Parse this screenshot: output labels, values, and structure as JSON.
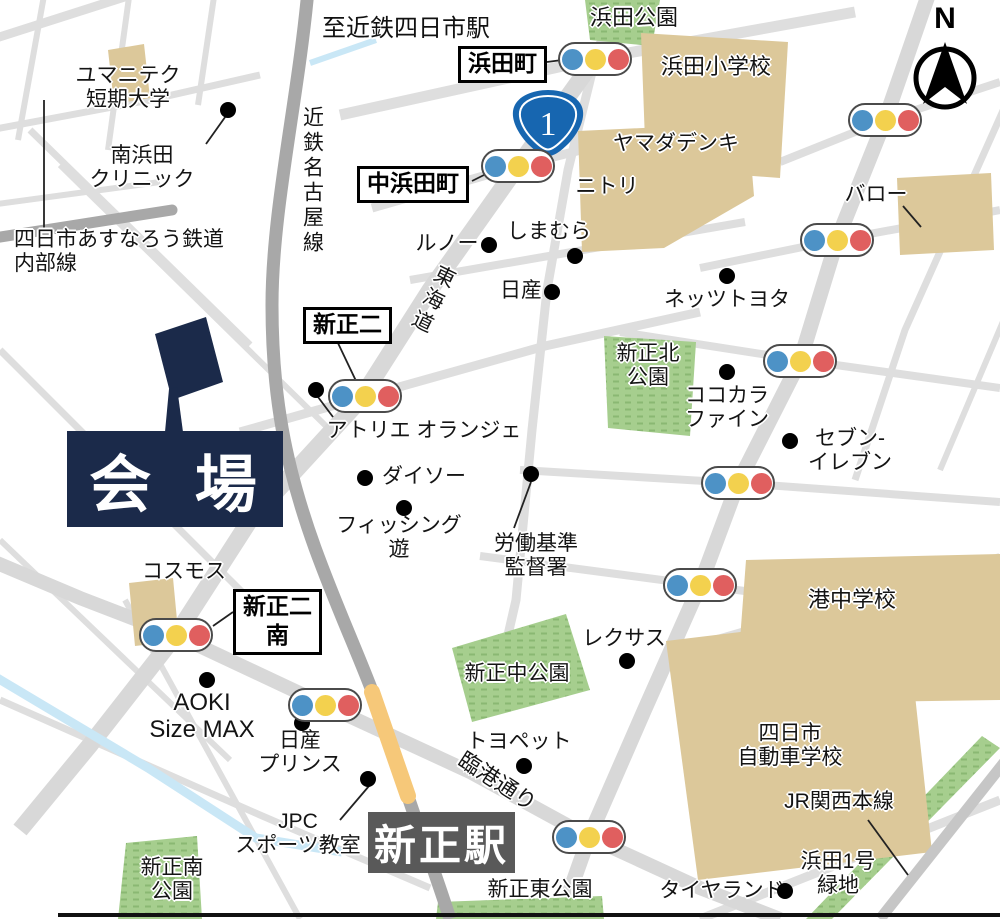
{
  "colors": {
    "road": "#d8d8d8",
    "road_minor": "#dedede",
    "railway": "#a8a8a8",
    "jr_rail": "#c6c6c6",
    "building": "#dcc89a",
    "park": "#a6ce8e",
    "park_hatch": "#8ab873",
    "water": "#c9e7f6",
    "navy": "#1b2a4a",
    "station_gray": "#595959",
    "shield_blue": "#1766b0",
    "light_blue": "#4d92c6",
    "light_yellow": "#f3d14e",
    "light_red": "#e05f5f",
    "station_band": "#f6c879"
  },
  "top_note": {
    "text": "至近鉄四日市駅"
  },
  "venue": {
    "label": "会 場"
  },
  "station": {
    "label": "新正駅"
  },
  "route_shield": {
    "number": "1"
  },
  "compass": {
    "label": "N"
  },
  "intersections": [
    {
      "name": "hamadacho",
      "lines": [
        "浜田町"
      ],
      "x": 458,
      "y": 46
    },
    {
      "name": "nakahamadacho",
      "lines": [
        "中浜田町"
      ],
      "x": 357,
      "y": 166
    },
    {
      "name": "shinsho-ni",
      "lines": [
        "新正二"
      ],
      "x": 303,
      "y": 307
    },
    {
      "name": "shinsho-ni-minami",
      "lines": [
        "新正二",
        "南"
      ],
      "x": 233,
      "y": 589
    }
  ],
  "traffic_lights": [
    {
      "x": 595,
      "y": 59
    },
    {
      "x": 518,
      "y": 166
    },
    {
      "x": 885,
      "y": 120
    },
    {
      "x": 837,
      "y": 240
    },
    {
      "x": 365,
      "y": 396
    },
    {
      "x": 800,
      "y": 361
    },
    {
      "x": 738,
      "y": 483
    },
    {
      "x": 700,
      "y": 585
    },
    {
      "x": 176,
      "y": 635
    },
    {
      "x": 325,
      "y": 705
    },
    {
      "x": 589,
      "y": 837
    }
  ],
  "poi_dots": [
    {
      "name": "minamihamada-clinic-dot",
      "x": 228,
      "y": 110
    },
    {
      "name": "renault-dot",
      "x": 489,
      "y": 245
    },
    {
      "name": "shimamura-dot",
      "x": 575,
      "y": 256
    },
    {
      "name": "nissan-dot",
      "x": 552,
      "y": 292
    },
    {
      "name": "netz-toyota-dot",
      "x": 727,
      "y": 276
    },
    {
      "name": "atelier-dot",
      "x": 316,
      "y": 390
    },
    {
      "name": "cocokara-dot",
      "x": 727,
      "y": 372
    },
    {
      "name": "seven-eleven-dot",
      "x": 790,
      "y": 441
    },
    {
      "name": "daiso-dot",
      "x": 365,
      "y": 478
    },
    {
      "name": "fishing-dot",
      "x": 404,
      "y": 508
    },
    {
      "name": "roudou-dot",
      "x": 531,
      "y": 474
    },
    {
      "name": "lexus-dot",
      "x": 627,
      "y": 661
    },
    {
      "name": "aoki-dot",
      "x": 207,
      "y": 680
    },
    {
      "name": "nissan-prince-dot",
      "x": 302,
      "y": 723
    },
    {
      "name": "toyopet-dot",
      "x": 524,
      "y": 766
    },
    {
      "name": "jpc-dot",
      "x": 368,
      "y": 779
    },
    {
      "name": "tireland-dot",
      "x": 785,
      "y": 891
    }
  ],
  "labels": [
    {
      "name": "hamada-park",
      "lines": [
        "浜田公園"
      ],
      "x": 634,
      "y": 6,
      "size": 22
    },
    {
      "name": "hamada-elementary",
      "lines": [
        "浜田小学校"
      ],
      "x": 716,
      "y": 55,
      "size": 22
    },
    {
      "name": "yumaniteku-college",
      "lines": [
        "ユマニテク",
        "短期大学"
      ],
      "x": 128,
      "y": 64
    },
    {
      "name": "minamihamada-clinic",
      "lines": [
        "南浜田",
        "クリニック"
      ],
      "x": 142,
      "y": 144
    },
    {
      "name": "kintetsu-nagoya-line",
      "lines": [
        "近鉄名古屋線"
      ],
      "x": 300,
      "y": 106,
      "vertical": true
    },
    {
      "name": "asunarou-line",
      "lines": [
        "四日市あすなろう鉄道",
        "内部線"
      ],
      "x": 14,
      "y": 228,
      "align": "left"
    },
    {
      "name": "yamada-denki",
      "lines": [
        "ヤマダデンキ"
      ],
      "x": 676,
      "y": 132
    },
    {
      "name": "nitori",
      "lines": [
        "ニトリ"
      ],
      "x": 607,
      "y": 175
    },
    {
      "name": "valor",
      "lines": [
        "バロー"
      ],
      "x": 876,
      "y": 183
    },
    {
      "name": "renault",
      "lines": [
        "ルノー"
      ],
      "x": 447,
      "y": 232
    },
    {
      "name": "shimamura",
      "lines": [
        "しまむら"
      ],
      "x": 549,
      "y": 220
    },
    {
      "name": "nissan",
      "lines": [
        "日産"
      ],
      "x": 521,
      "y": 279
    },
    {
      "name": "netz-toyota",
      "lines": [
        "ネッツトヨタ"
      ],
      "x": 727,
      "y": 288
    },
    {
      "name": "tokaido",
      "lines": [
        "東海道"
      ],
      "x": 420,
      "y": 262,
      "vertical": true,
      "rotate": 26
    },
    {
      "name": "shinsho-kita-park",
      "lines": [
        "新正北",
        "公園"
      ],
      "x": 648,
      "y": 342
    },
    {
      "name": "cocokara-fine",
      "lines": [
        "ココカラ",
        "ファイン"
      ],
      "x": 727,
      "y": 384
    },
    {
      "name": "seven-eleven",
      "lines": [
        "セブン-",
        "イレブン"
      ],
      "x": 850,
      "y": 427
    },
    {
      "name": "atelier-orange",
      "lines": [
        "アトリエ オランジェ"
      ],
      "x": 424,
      "y": 419
    },
    {
      "name": "daiso",
      "lines": [
        "ダイソー"
      ],
      "x": 424,
      "y": 465
    },
    {
      "name": "fishing-yu",
      "lines": [
        "フィッシング",
        "遊"
      ],
      "x": 399,
      "y": 514
    },
    {
      "name": "roudou-kijun",
      "lines": [
        "労働基準",
        "監督署"
      ],
      "x": 536,
      "y": 532
    },
    {
      "name": "cosmos",
      "lines": [
        "コスモス"
      ],
      "x": 184,
      "y": 560
    },
    {
      "name": "minato-junior-high",
      "lines": [
        "港中学校"
      ],
      "x": 852,
      "y": 588,
      "size": 22
    },
    {
      "name": "lexus",
      "lines": [
        "レクサス"
      ],
      "x": 624,
      "y": 627
    },
    {
      "name": "shinsho-naka-park",
      "lines": [
        "新正中公園"
      ],
      "x": 517,
      "y": 662
    },
    {
      "name": "aoki-sizemax",
      "lines": [
        "AOKI",
        "Size MAX"
      ],
      "x": 202,
      "y": 690,
      "size": 24
    },
    {
      "name": "nissan-prince",
      "lines": [
        "日産",
        "プリンス"
      ],
      "x": 300,
      "y": 729
    },
    {
      "name": "toyopet",
      "lines": [
        "トヨペット"
      ],
      "x": 519,
      "y": 730
    },
    {
      "name": "rinko-dori",
      "lines": [
        "臨港通り"
      ],
      "x": 497,
      "y": 782,
      "rotate": 33,
      "size": 22
    },
    {
      "name": "jpc-sports",
      "lines": [
        "JPC",
        "スポーツ教室"
      ],
      "x": 298,
      "y": 810
    },
    {
      "name": "yokkaichi-driving-school",
      "lines": [
        "四日市",
        "自動車学校"
      ],
      "x": 790,
      "y": 722
    },
    {
      "name": "jr-kansai-line",
      "lines": [
        "JR関西本線"
      ],
      "x": 839,
      "y": 790
    },
    {
      "name": "hamada1-ryokuchi",
      "lines": [
        "浜田1号",
        "緑地"
      ],
      "x": 838,
      "y": 850
    },
    {
      "name": "tireland",
      "lines": [
        "タイヤランド"
      ],
      "x": 722,
      "y": 879
    },
    {
      "name": "shinsho-higashi-park",
      "lines": [
        "新正東公園"
      ],
      "x": 540,
      "y": 878
    },
    {
      "name": "shinsho-minami-park",
      "lines": [
        "新正南",
        "公園"
      ],
      "x": 172,
      "y": 856
    }
  ]
}
